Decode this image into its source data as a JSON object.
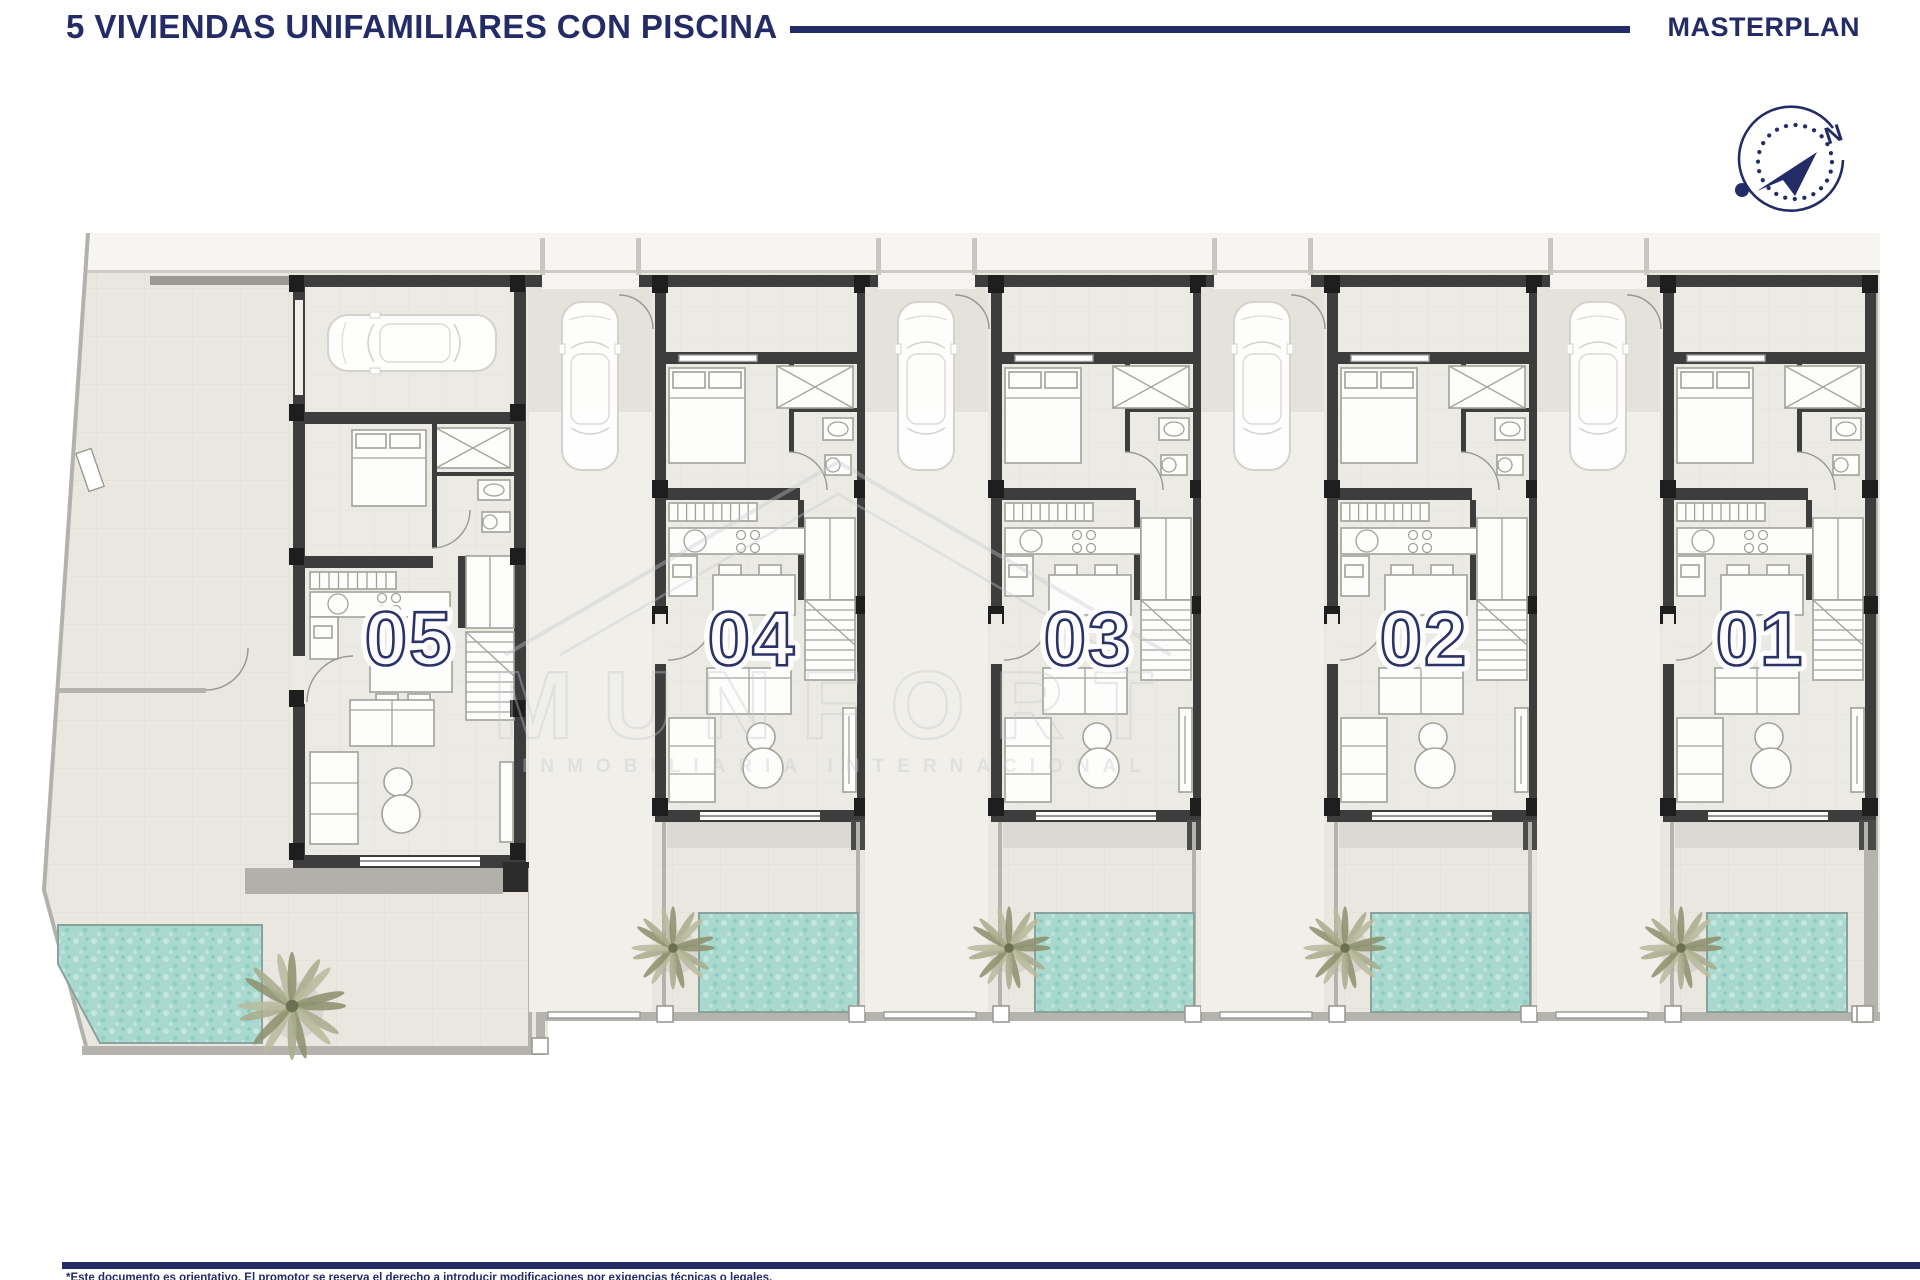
{
  "header": {
    "title": "5 VIVIENDAS UNIFAMILIARES CON PISCINA",
    "right_label": "MASTERPLAN"
  },
  "compass": {
    "north_label": "N"
  },
  "plan": {
    "units": [
      {
        "number": "05"
      },
      {
        "number": "04"
      },
      {
        "number": "03"
      },
      {
        "number": "02"
      },
      {
        "number": "01"
      }
    ]
  },
  "watermark": {
    "brand": "MUNFORT",
    "subtitle": "INMOBILIARIA INTERNACIONAL"
  },
  "footer": {
    "disclaimer": "*Este documento es orientativo. El promotor se reserva el derecho a introducir modificaciones por exigencias técnicas o legales."
  },
  "colors": {
    "navy": "#232c66",
    "pool_water": "#a9d8cf",
    "wall_dark": "#3d3d3d",
    "plot_ground": "#e9e7e0",
    "palm_green": "#9aa07c"
  }
}
